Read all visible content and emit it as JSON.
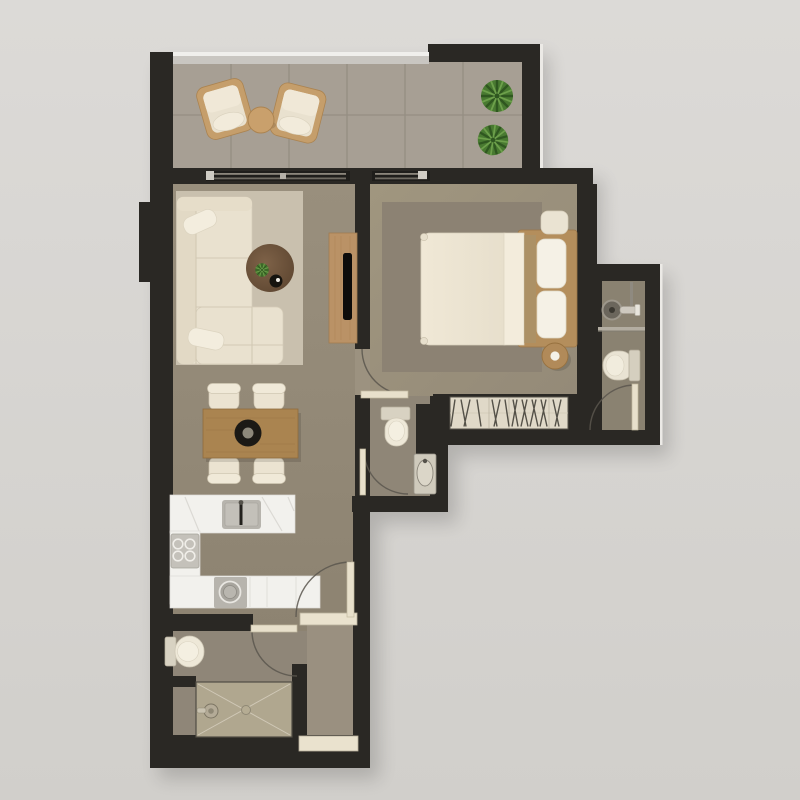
{
  "plan": {
    "type": "apartment-floor-plan-top-view",
    "rooms": [
      {
        "name": "balcony",
        "furniture": [
          "lounge-chair",
          "lounge-chair",
          "round-side-table",
          "potted-plant",
          "potted-plant"
        ]
      },
      {
        "name": "living-room",
        "furniture": [
          "area-rug",
          "l-shaped-sofa",
          "throw-pillow",
          "throw-pillow",
          "round-coffee-table",
          "table-plant",
          "decor-tray",
          "media-console",
          "tv"
        ]
      },
      {
        "name": "dining-area",
        "furniture": [
          "dining-table",
          "dining-chair",
          "dining-chair",
          "dining-chair",
          "dining-chair",
          "centerpiece-bowl"
        ]
      },
      {
        "name": "kitchen",
        "furniture": [
          "counter-with-sink",
          "sink-faucet",
          "side-counter",
          "cooktop-4-burners",
          "under-counter-washing-machine"
        ]
      },
      {
        "name": "bedroom",
        "furniture": [
          "area-rug",
          "double-bed",
          "pillow",
          "pillow",
          "nightstand",
          "round-stool",
          "built-in-wardrobe"
        ]
      },
      {
        "name": "guest-wc",
        "furniture": [
          "toilet",
          "washbasin"
        ]
      },
      {
        "name": "ensuite-bathroom",
        "furniture": [
          "vanity-basin",
          "faucet",
          "toilet"
        ]
      },
      {
        "name": "bathroom",
        "furniture": [
          "toilet",
          "walk-in-shower",
          "shower-mixer",
          "floor-drain"
        ]
      },
      {
        "name": "hallway",
        "furniture": [
          "entry-threshold"
        ]
      }
    ],
    "doors": [
      "living-balcony-slider",
      "bedroom-balcony-slider",
      "bedroom-door",
      "guest-wc-door",
      "ensuite-door",
      "bathroom-door",
      "entry-door"
    ]
  },
  "palette": {
    "background_top": "#dcdad7",
    "background_bottom": "#d1cfcb",
    "wall": "#2a2824",
    "wall_dark": "#1f1e1b",
    "wall_edge": "#eceae6",
    "floor_balcony": "#a79f94",
    "floor_living": "#968c7a",
    "floor_bedroom": "#9c9280",
    "floor_wc": "#8f8677",
    "floor_ensuite": "#8a8271",
    "floor_bath": "#8f8678",
    "floor_hall": "#9a9080",
    "rug_living": "#c9c0ae",
    "rug_bedroom": "#8c8273",
    "tile_line": "#948c81",
    "shower_tile": "#b0a78f",
    "cream": "#e9e1cf",
    "cream_light": "#f3eee0",
    "wood": "#ba9266",
    "wood_mid": "#aa8450",
    "wood_dark": "#6a4f37",
    "marble": "#f2f1ed",
    "appliance": "#b7b4ad",
    "plant": "#497a31",
    "plant_dark": "#2f5720",
    "plant_light": "#6da04b",
    "door_leaf": "#e8e0cb",
    "threshold": "#eae2ce",
    "arc": "#5b564d",
    "railing": "#c9c6c1",
    "glass_line": "#8b867c",
    "black": "#110f0c",
    "metal": "#6b665c"
  }
}
